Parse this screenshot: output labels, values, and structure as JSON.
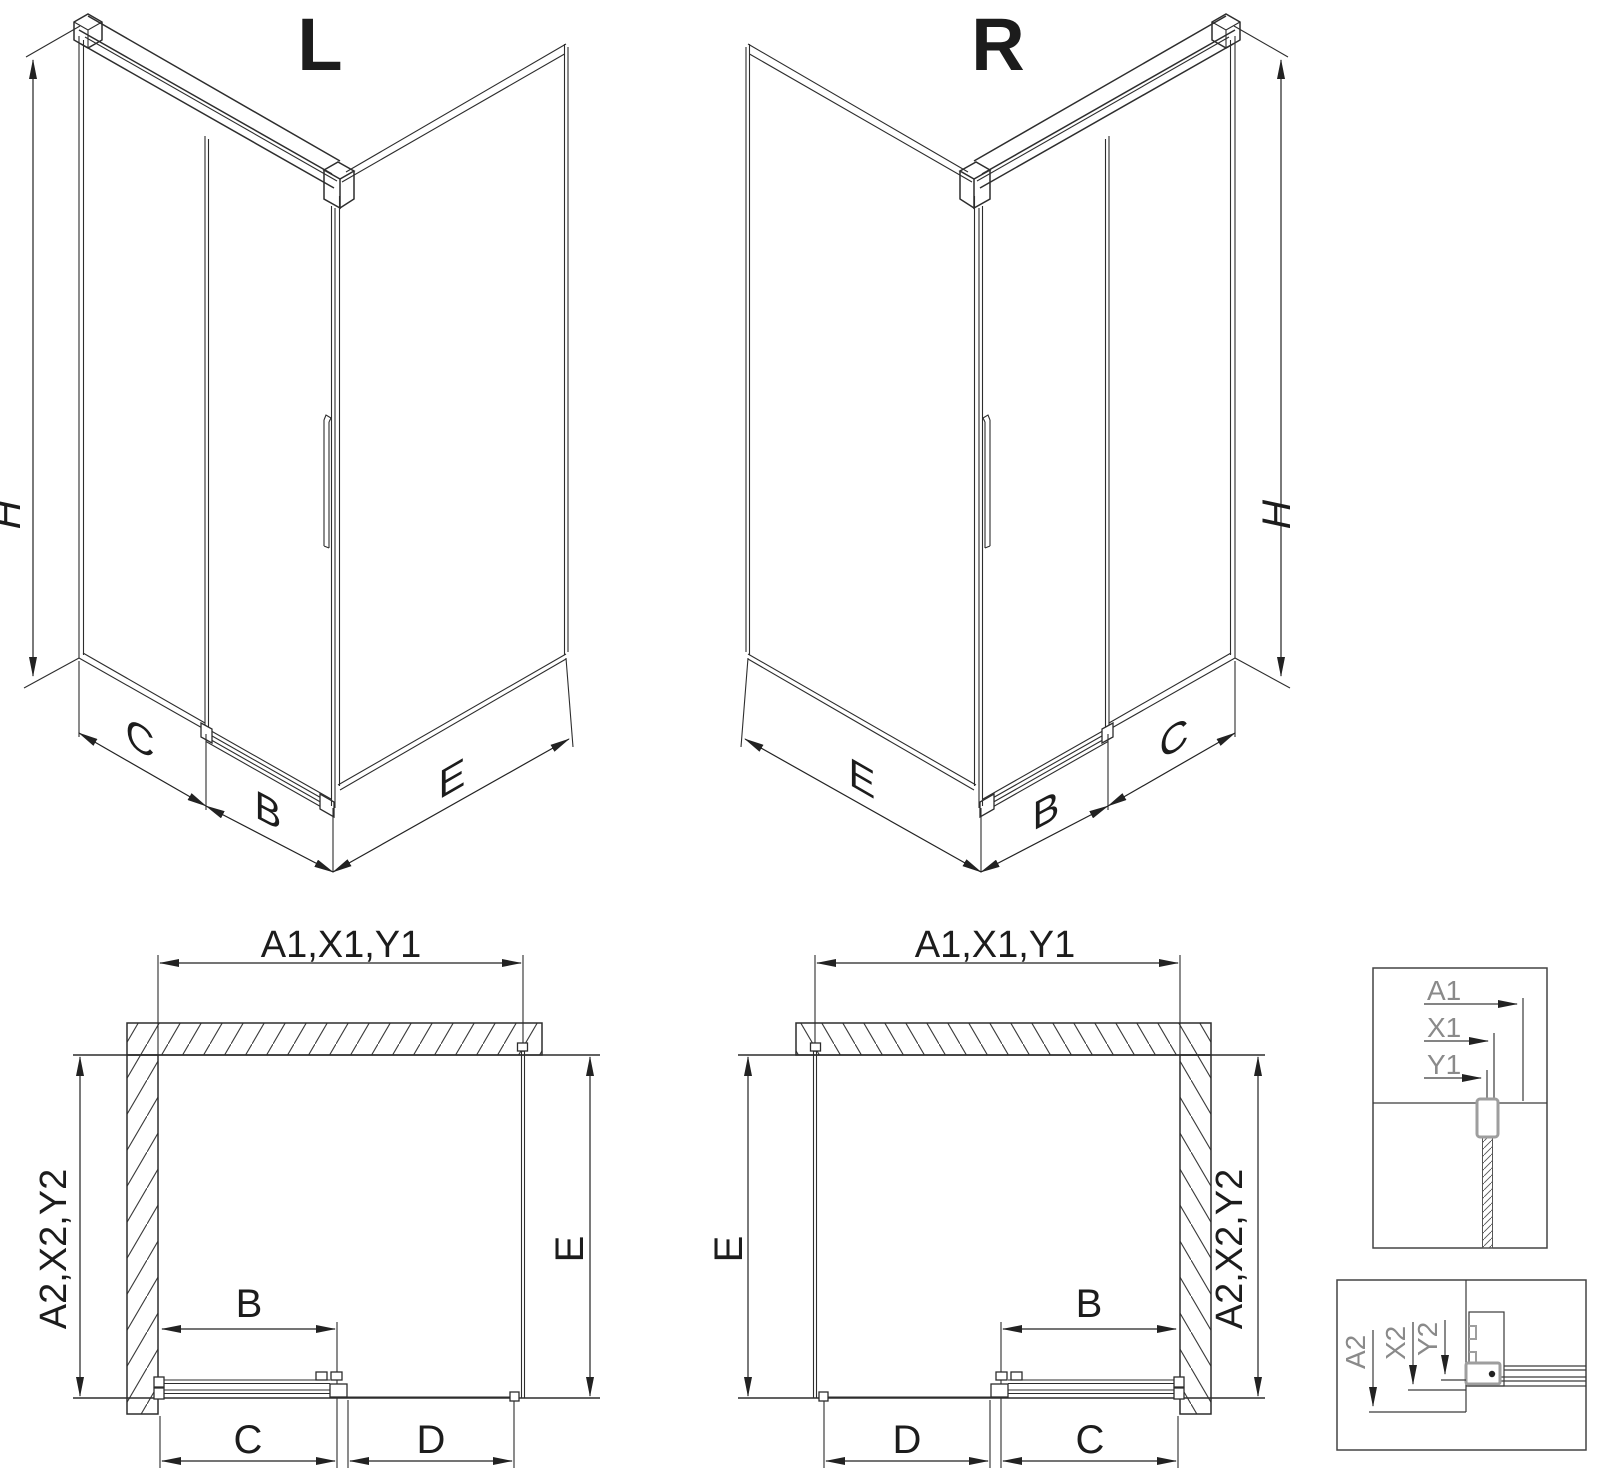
{
  "iso_left": {
    "title": "L",
    "height_label": "H",
    "fixed_panel_label": "C",
    "door_label": "B",
    "return_panel_label": "E"
  },
  "iso_right": {
    "title": "R",
    "height_label": "H",
    "return_panel_label": "E",
    "door_label": "B",
    "fixed_panel_label": "C"
  },
  "plan_left": {
    "width_labels": "A1,X1,Y1",
    "depth_labels": "A2,X2,Y2",
    "return_label": "E",
    "door_label": "B",
    "fixed_label": "C",
    "opening_label": "D"
  },
  "plan_right": {
    "width_labels": "A1,X1,Y1",
    "return_label": "E",
    "depth_labels": "A2,X2,Y2",
    "door_label": "B",
    "opening_label": "D",
    "fixed_label": "C"
  },
  "detail_width": {
    "label_a": "A1",
    "label_x": "X1",
    "label_y": "Y1"
  },
  "detail_depth": {
    "label_a": "A2",
    "label_x": "X2",
    "label_y": "Y2"
  },
  "colors": {
    "line": "#2d2d2d",
    "detail_text": "#8a8a8a",
    "profile_gray": "#9e9e9e",
    "background": "#ffffff"
  }
}
